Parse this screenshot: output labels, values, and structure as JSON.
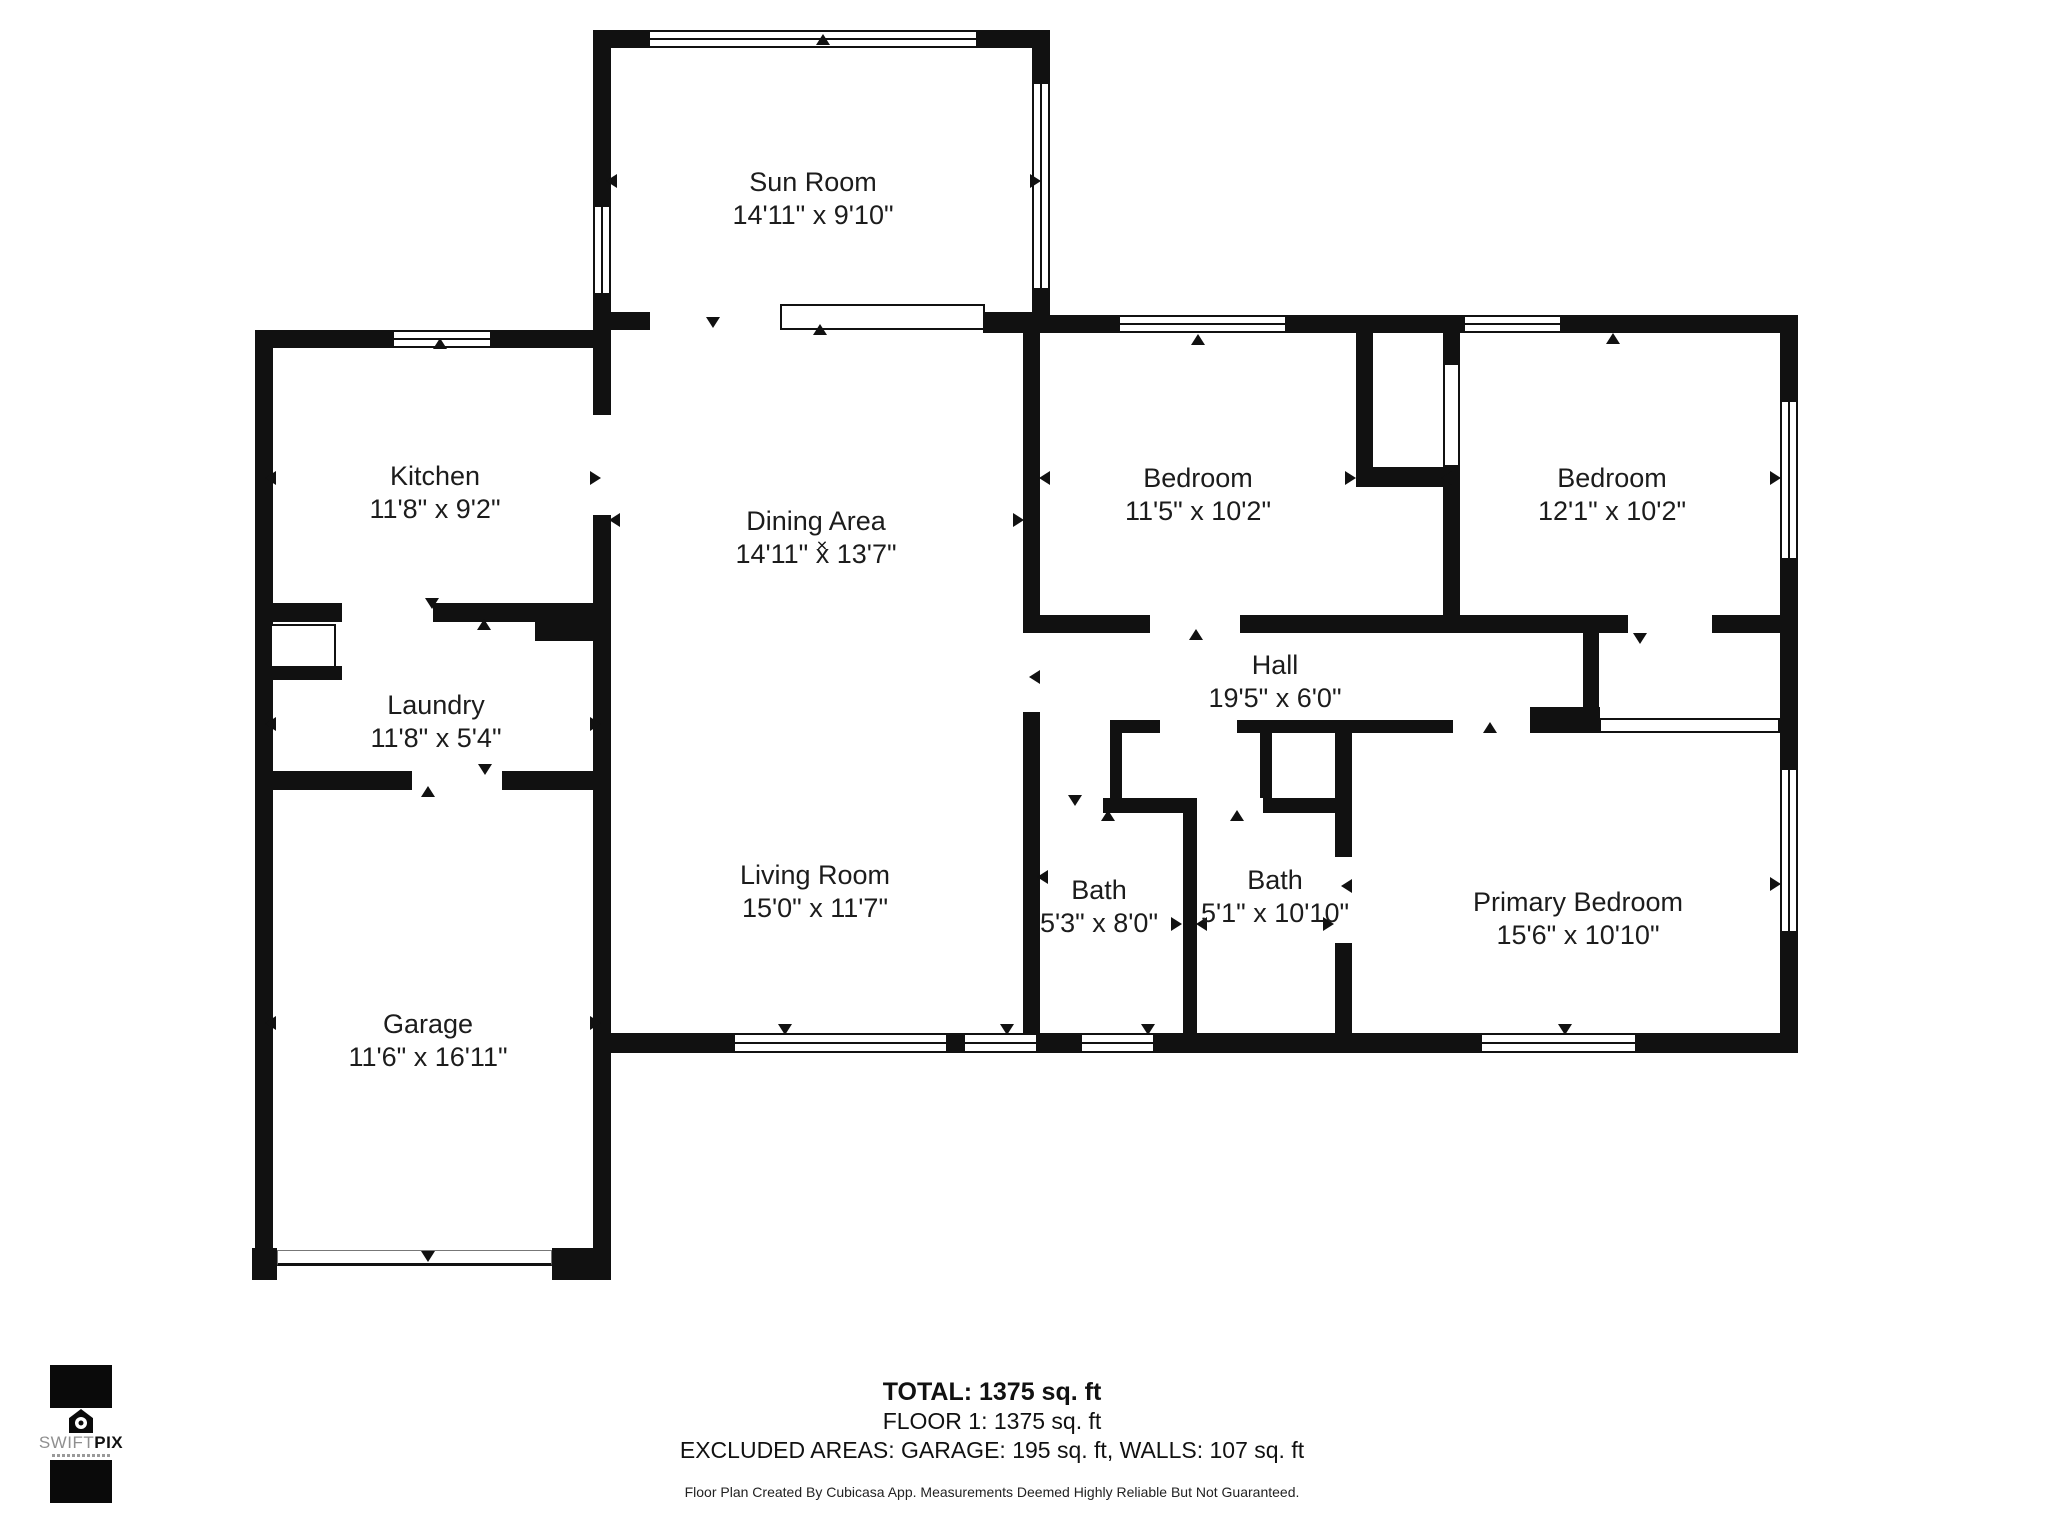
{
  "footer": {
    "total": "TOTAL: 1375 sq. ft",
    "floor": "FLOOR 1: 1375 sq. ft",
    "excluded": "EXCLUDED AREAS: GARAGE: 195 sq. ft, WALLS: 107 sq. ft",
    "disclaimer": "Floor Plan Created By Cubicasa App. Measurements Deemed Highly Reliable But Not Guaranteed."
  },
  "logo": {
    "brand_light": "SWIFT",
    "brand_bold": "PIX"
  },
  "plan": {
    "width": 2048,
    "height": 1536,
    "wall_color": "#111111",
    "rooms": [
      {
        "name": "Sun Room",
        "dims": "14'11\" x 9'10\"",
        "x": 813,
        "y": 199
      },
      {
        "name": "Kitchen",
        "dims": "11'8\" x 9'2\"",
        "x": 435,
        "y": 493
      },
      {
        "name": "Dining Area",
        "dims": "14'11\" x 13'7\"",
        "x": 816,
        "y": 538
      },
      {
        "name": "Bedroom",
        "dims": "11'5\" x 10'2\"",
        "x": 1198,
        "y": 495
      },
      {
        "name": "Bedroom",
        "dims": "12'1\" x 10'2\"",
        "x": 1612,
        "y": 495
      },
      {
        "name": "Hall",
        "dims": "19'5\" x 6'0\"",
        "x": 1275,
        "y": 682
      },
      {
        "name": "Laundry",
        "dims": "11'8\" x 5'4\"",
        "x": 436,
        "y": 722
      },
      {
        "name": "Living Room",
        "dims": "15'0\" x 11'7\"",
        "x": 815,
        "y": 892
      },
      {
        "name": "Bath",
        "dims": "5'3\" x 8'0\"",
        "x": 1099,
        "y": 907
      },
      {
        "name": "Bath",
        "dims": "5'1\" x 10'10\"",
        "x": 1275,
        "y": 897
      },
      {
        "name": "Primary Bedroom",
        "dims": "15'6\" x 10'10\"",
        "x": 1578,
        "y": 919
      },
      {
        "name": "Garage",
        "dims": "11'6\" x 16'11\"",
        "x": 428,
        "y": 1041
      }
    ],
    "walls": [
      [
        593,
        30,
        55,
        18
      ],
      [
        978,
        30,
        72,
        18
      ],
      [
        593,
        48,
        18,
        157
      ],
      [
        593,
        295,
        18,
        53
      ],
      [
        1032,
        30,
        18,
        52
      ],
      [
        1032,
        290,
        18,
        43
      ],
      [
        593,
        312,
        57,
        18
      ],
      [
        983,
        312,
        67,
        21
      ],
      [
        1050,
        315,
        68,
        18
      ],
      [
        1287,
        315,
        176,
        18
      ],
      [
        1562,
        315,
        236,
        18
      ],
      [
        1780,
        333,
        18,
        67
      ],
      [
        1780,
        560,
        18,
        208
      ],
      [
        1780,
        933,
        18,
        120
      ],
      [
        255,
        330,
        137,
        18
      ],
      [
        492,
        330,
        119,
        18
      ],
      [
        255,
        348,
        18,
        932
      ],
      [
        593,
        330,
        18,
        85
      ],
      [
        593,
        515,
        18,
        88
      ],
      [
        535,
        603,
        76,
        38
      ],
      [
        268,
        603,
        74,
        19
      ],
      [
        433,
        603,
        104,
        19
      ],
      [
        266,
        666,
        76,
        14
      ],
      [
        268,
        771,
        144,
        19
      ],
      [
        502,
        771,
        109,
        19
      ],
      [
        593,
        641,
        18,
        607
      ],
      [
        252,
        1248,
        25,
        32
      ],
      [
        552,
        1248,
        59,
        32
      ],
      [
        593,
        1033,
        140,
        20
      ],
      [
        948,
        1033,
        15,
        20
      ],
      [
        1038,
        1033,
        42,
        20
      ],
      [
        1155,
        1033,
        325,
        20
      ],
      [
        1637,
        1033,
        143,
        20
      ],
      [
        1023,
        315,
        17,
        318
      ],
      [
        1023,
        712,
        17,
        321
      ],
      [
        1356,
        333,
        17,
        134
      ],
      [
        1356,
        467,
        104,
        20
      ],
      [
        1443,
        333,
        17,
        30
      ],
      [
        1443,
        487,
        17,
        146
      ],
      [
        1040,
        615,
        110,
        18
      ],
      [
        1240,
        615,
        388,
        18
      ],
      [
        1712,
        615,
        68,
        18
      ],
      [
        1110,
        720,
        50,
        13
      ],
      [
        1237,
        720,
        216,
        13
      ],
      [
        1110,
        722,
        12,
        91
      ],
      [
        1260,
        722,
        12,
        76
      ],
      [
        1103,
        798,
        94,
        15
      ],
      [
        1263,
        798,
        72,
        15
      ],
      [
        1530,
        707,
        70,
        26
      ],
      [
        1583,
        633,
        16,
        80
      ],
      [
        1183,
        813,
        14,
        220
      ],
      [
        1335,
        733,
        17,
        124
      ],
      [
        1335,
        943,
        17,
        90
      ]
    ],
    "windows": [
      [
        648,
        30,
        330,
        18
      ],
      [
        392,
        330,
        100,
        18
      ],
      [
        1118,
        315,
        169,
        18
      ],
      [
        1463,
        315,
        99,
        18
      ],
      [
        733,
        1033,
        215,
        20
      ],
      [
        963,
        1033,
        75,
        20
      ],
      [
        1080,
        1033,
        75,
        20
      ],
      [
        1480,
        1033,
        157,
        20
      ],
      [
        593,
        205,
        18,
        90
      ],
      [
        1032,
        82,
        18,
        208
      ],
      [
        1780,
        400,
        18,
        160
      ],
      [
        1780,
        768,
        18,
        165
      ]
    ],
    "features": [
      {
        "kind": "slider",
        "x": 780,
        "y": 304,
        "w": 205,
        "h": 26
      },
      {
        "kind": "slider",
        "x": 1443,
        "y": 363,
        "w": 17,
        "h": 104
      },
      {
        "kind": "slider",
        "x": 1599,
        "y": 718,
        "w": 181,
        "h": 15
      },
      {
        "kind": "alcove",
        "x": 270,
        "y": 624,
        "w": 66,
        "h": 44
      },
      {
        "kind": "garage-door",
        "x": 277,
        "y": 1250,
        "w": 275,
        "h": 16
      },
      {
        "kind": "cross",
        "x": 822,
        "y": 546,
        "glyph": "✕"
      }
    ],
    "arrows": [
      [
        613,
        180,
        "left"
      ],
      [
        1037,
        180,
        "right"
      ],
      [
        823,
        40,
        "up"
      ],
      [
        713,
        323,
        "down"
      ],
      [
        820,
        330,
        "up"
      ],
      [
        272,
        477,
        "left"
      ],
      [
        597,
        477,
        "right"
      ],
      [
        440,
        344,
        "up"
      ],
      [
        432,
        604,
        "down"
      ],
      [
        484,
        625,
        "up"
      ],
      [
        272,
        723,
        "left"
      ],
      [
        597,
        723,
        "right"
      ],
      [
        485,
        770,
        "down"
      ],
      [
        428,
        792,
        "up"
      ],
      [
        272,
        1022,
        "left"
      ],
      [
        597,
        1022,
        "right"
      ],
      [
        428,
        1257,
        "down"
      ],
      [
        616,
        519,
        "left"
      ],
      [
        1020,
        519,
        "right"
      ],
      [
        1046,
        477,
        "left"
      ],
      [
        1352,
        477,
        "right"
      ],
      [
        1198,
        340,
        "up"
      ],
      [
        1196,
        635,
        "up"
      ],
      [
        1448,
        477,
        "left"
      ],
      [
        1613,
        339,
        "up"
      ],
      [
        1777,
        477,
        "right"
      ],
      [
        1640,
        639,
        "down"
      ],
      [
        1036,
        676,
        "left"
      ],
      [
        785,
        1030,
        "down"
      ],
      [
        1007,
        1030,
        "down"
      ],
      [
        1148,
        1030,
        "down"
      ],
      [
        1565,
        1030,
        "down"
      ],
      [
        1075,
        801,
        "down"
      ],
      [
        1108,
        816,
        "up"
      ],
      [
        1237,
        816,
        "up"
      ],
      [
        1044,
        876,
        "left"
      ],
      [
        1178,
        923,
        "right"
      ],
      [
        1203,
        923,
        "left"
      ],
      [
        1330,
        923,
        "right"
      ],
      [
        1348,
        885,
        "left"
      ],
      [
        1490,
        728,
        "up"
      ],
      [
        1777,
        883,
        "right"
      ]
    ]
  }
}
